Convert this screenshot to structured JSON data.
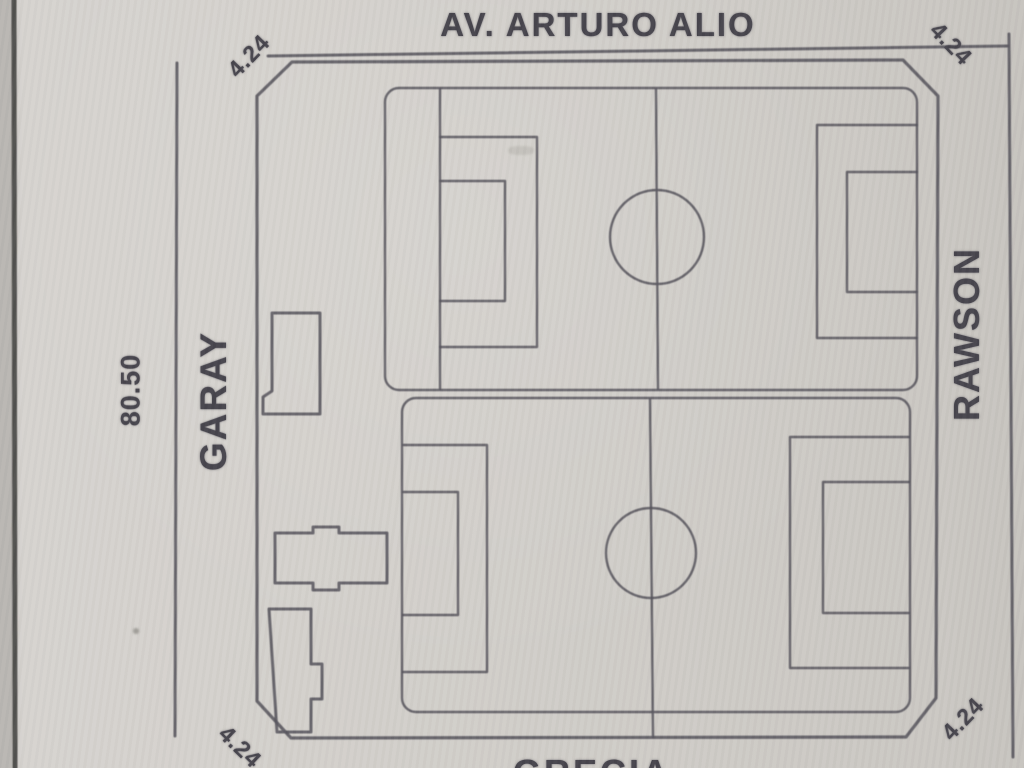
{
  "plan": {
    "streets": {
      "top": "AV. ARTURO ALIO",
      "left": "GARAY",
      "right": "RAWSON",
      "bottom": "GRECIA"
    },
    "dimensions": {
      "left_side_length": "80.50",
      "corner_chamfers": [
        {
          "position": "top-left",
          "value": "4.24"
        },
        {
          "position": "top-right",
          "value": "4.24"
        },
        {
          "position": "bottom-right",
          "value": "4.24"
        },
        {
          "position": "bottom-left",
          "value": "4.24"
        }
      ]
    },
    "content": {
      "soccer_fields_count": 2,
      "building_outlines_count": 3
    },
    "colors": {
      "paper": "#d0cdc8",
      "ink": "#57545c",
      "text": "#45434b"
    }
  }
}
